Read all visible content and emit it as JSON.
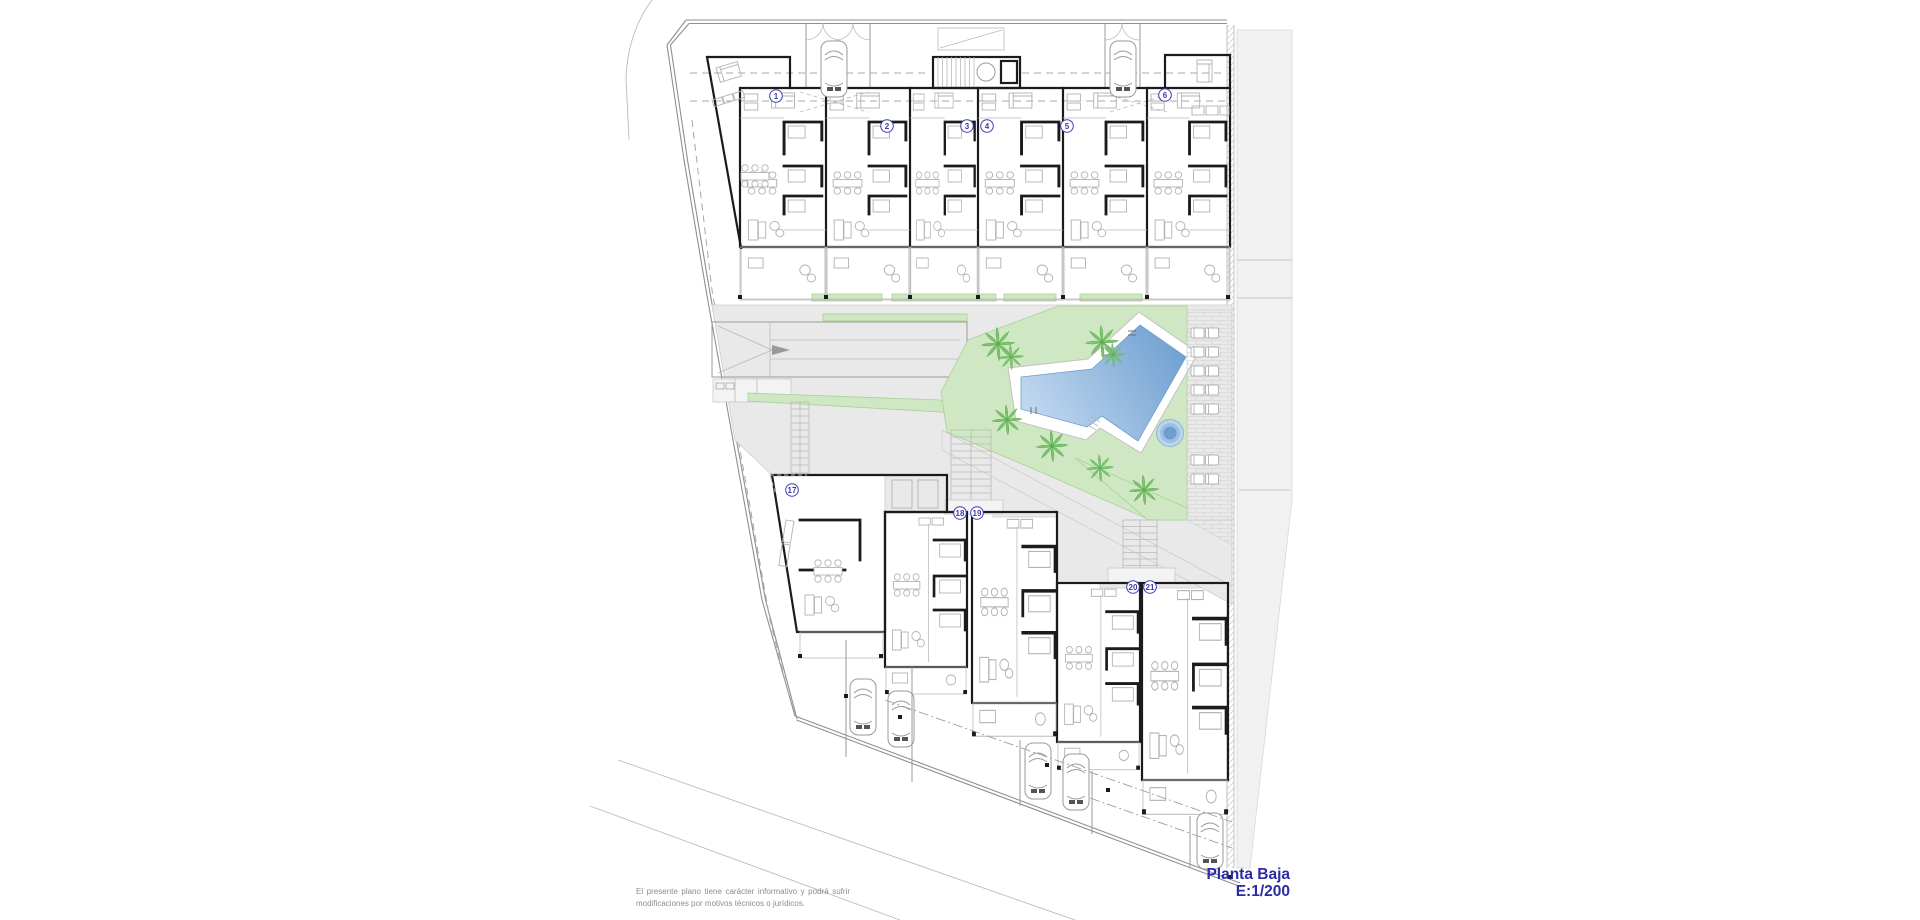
{
  "sheet": {
    "title": "Planta Baja",
    "scale": "E:1/200",
    "disclaimer": "El presente plano tiene carácter informativo y podrá sufrir modificaciones por motivos técnicos o jurídicos.",
    "units": {
      "top_row": [
        "1",
        "2",
        "3",
        "4",
        "5",
        "6"
      ],
      "bottom_row": [
        "17",
        "18",
        "19",
        "20",
        "21"
      ]
    },
    "amenities": [
      "swimming-pool",
      "jacuzzi",
      "lawn",
      "palm-trees",
      "sun-loungers",
      "parking-ramp",
      "staircases",
      "garages",
      "parking-spaces"
    ],
    "colors": {
      "title_text": "#2b2ba4",
      "disclaimer_text": "#8c8c8c",
      "wall": "#1b1b1b",
      "line": "#9a9a9a",
      "paving": "#e9e9e9",
      "neighbor": "#f1f1f1",
      "lawn": "#cfe8c3",
      "lawn_edge": "#a6d297",
      "palm": "#7fc571",
      "pool_light": "#c7dcf2",
      "pool_dark": "#6d9ed0",
      "badge": "#3c3caa"
    }
  }
}
